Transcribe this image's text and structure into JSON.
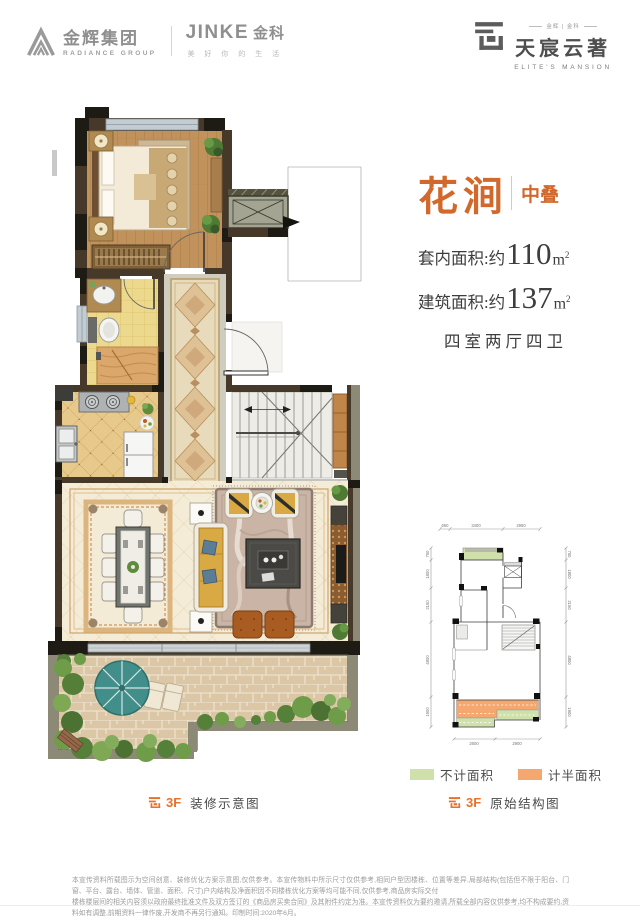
{
  "header": {
    "radiance_cn": "金辉集团",
    "radiance_en": "RADIANCE GROUP",
    "jinke_brand": "JINKE",
    "jinke_cn": "金科",
    "jinke_tagline": "美 好 你 的 生 活",
    "mansion_small": "金辉 | 金科",
    "mansion_cn": "天宸云著",
    "mansion_en": "ELITE'S MANSION"
  },
  "info": {
    "title": "花涧",
    "tag": "中叠",
    "area1_label": "套内面积:约",
    "area1_value": "110",
    "area1_unit": "m",
    "area1_sup": "2",
    "area2_label": "建筑面积:约",
    "area2_value": "137",
    "area2_unit": "m",
    "area2_sup": "2",
    "layout": "四室两厅四卫"
  },
  "legend": {
    "green_label": "不计面积",
    "orange_label": "计半面积",
    "green_color": "#cfe0ab",
    "orange_color": "#f4a76f"
  },
  "captions": {
    "left_floor": "3F",
    "left_text": "装修示意图",
    "right_floor": "3F",
    "right_text": "原始结构图"
  },
  "diagram_dims": {
    "top": [
      "650",
      "3400",
      "2950"
    ],
    "left": [
      "750",
      "1800",
      "2150",
      "4800",
      "1900"
    ],
    "right": [
      "750",
      "1800",
      "2150",
      "4800",
      "1900"
    ],
    "bottom": [
      "2600",
      "2900"
    ]
  },
  "disclaimer": {
    "line1": "本宣传资料所载图示为空间创意、装修优化方案示意图,仅供参考。本宣传物料中所示尺寸仅供参考,相同户型因楼栋、位置等差异,局部结构(包括但不限于阳台、门窗、平台、露台、墙体、管道、面积、尺寸)户内结构及净面积因不同楼栋优化方案等均可能不同,仅供参考,商品房实际交付",
    "line2": "楼栋楼层间的相关内容须以政府最终批准文件及双方签订的《商品房买卖合同》及其附件约定为准。本宣传资料仅为要约邀请,所载全部内容仅供参考,均不构成要约,资料如有调整,前期资料一律作废,开发商不再另行通知。印制时间:2020年6月。"
  },
  "accent_color": "#d2682c"
}
